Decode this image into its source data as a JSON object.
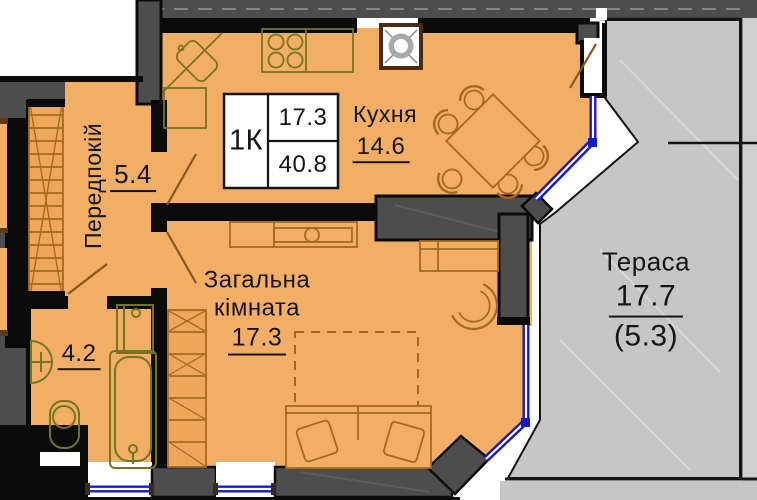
{
  "floorplan": {
    "unit_box": {
      "type": "1К",
      "room_area": "17.3",
      "total_area": "40.8"
    },
    "rooms": {
      "hallway": {
        "name": "Передпокій",
        "area": "5.4"
      },
      "kitchen": {
        "name": "Кухня",
        "area": "14.6"
      },
      "living": {
        "name": "Загальна кімната",
        "area": "17.3"
      },
      "bathroom": {
        "area": "4.2"
      },
      "terrace": {
        "name": "Тераса",
        "area": "17.7",
        "reduced_area": "(5.3)"
      }
    },
    "colors": {
      "floor": "#F3AE66",
      "wall_gray": "#4D4D4D",
      "wall_black": "#0B0B0B",
      "terrace_gray": "#C6C6C6",
      "window_blue": "#1718CF",
      "furniture_brown": "#A5691E",
      "fixture_olive": "#757520"
    }
  }
}
